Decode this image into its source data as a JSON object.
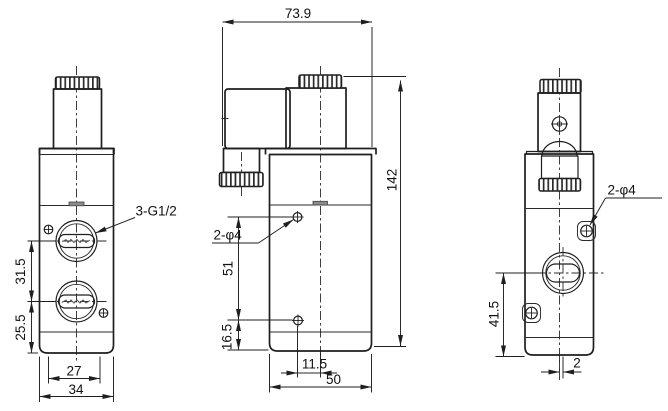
{
  "drawing_type": "valve dimensional drawing",
  "colors": {
    "line": "#1f1f1f",
    "background": "#ffffff",
    "tab_fill": "#8a8a8a"
  },
  "views": {
    "front": {
      "thread_label": "3-G1/2",
      "dims": {
        "port_spacing": "31.5",
        "port_to_bottom": "25.5",
        "screw_spacing": "27",
        "body_width": "34"
      }
    },
    "side": {
      "hole_label": "2-φ4",
      "dims": {
        "overall_width": "73.9",
        "overall_height": "142",
        "hole_spacing": "51",
        "hole_to_bottom": "16.5",
        "hole_offset": "11.5",
        "body_depth": "50"
      }
    },
    "back": {
      "hole_label": "2-φ4",
      "dims": {
        "port_height": "41.5",
        "center_offset": "2"
      }
    }
  }
}
